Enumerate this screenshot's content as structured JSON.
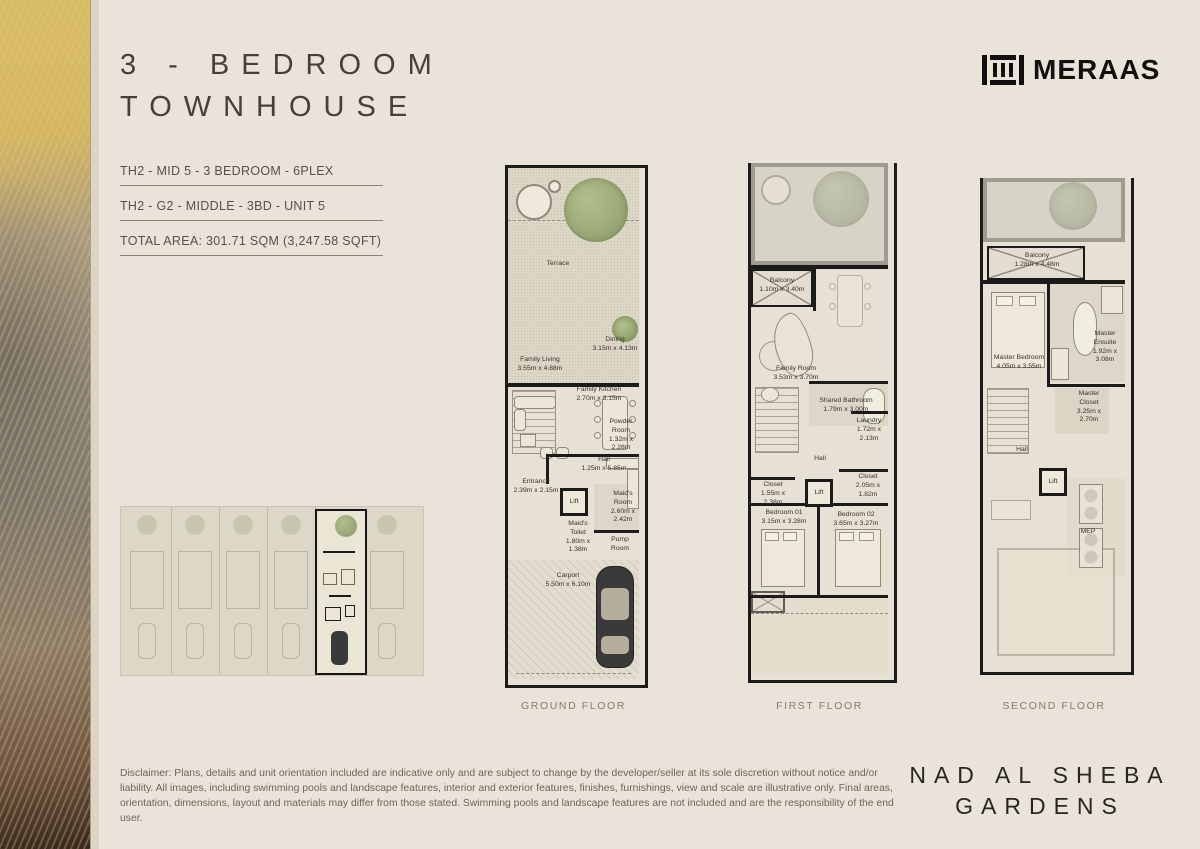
{
  "header": {
    "title": "3 - BEDROOM\nTOWNHOUSE",
    "unit_code": "TH2 - MID 5 - 3 BEDROOM - 6PLEX",
    "unit_detail": "TH2 - G2 - MIDDLE - 3BD - UNIT 5",
    "total_area": "TOTAL AREA: 301.71 SQM (3,247.58 SQFT)",
    "brand": "MERAAS"
  },
  "icons": {
    "logo_mark": "meraas-bars-glyph"
  },
  "plans": {
    "ground": {
      "name": "GROUND FLOOR",
      "rooms": {
        "terrace": "Terrace",
        "dining": "Dining\n3.15m x 4.13m",
        "family_living": "Family Living\n3.55m x 4.88m",
        "family_kitchen": "Family Kitchen\n2.70m x 3.15m",
        "powder_room": "Powder\nRoom\n1.32m x\n2.28m",
        "hall": "Hall\n1.25m x 5.85m",
        "entrance": "Entrance\n2.39m x 2.15m",
        "lift": "Lift",
        "maids_room": "Maid's\nRoom\n2.60m x\n2.42m",
        "maids_toilet": "Maid's\nToilet\n1.80m x\n1.38m",
        "pump_room": "Pump\nRoom",
        "carport": "Carport\n5.50m x 6.10m"
      }
    },
    "first": {
      "name": "FIRST FLOOR",
      "rooms": {
        "balcony": "Balcony\n1.10m x 3.40m",
        "family_room": "Family Room\n3.53m x 3.70m",
        "shared_bathroom": "Shared Bathroom\n1.79m x 3.00m",
        "laundry": "Laundry\n1.72m x\n2.13m",
        "hall": "Hall",
        "closet_1": "Closet\n1.55m x\n2.38m",
        "lift": "Lift",
        "closet_2": "Closet\n2.05m x\n1.82m",
        "bedroom_01": "Bedroom 01\n3.15m x 3.28m",
        "bedroom_02": "Bedroom 02\n3.65m x 3.27m"
      }
    },
    "second": {
      "name": "SECOND FLOOR",
      "rooms": {
        "balcony": "Balcony\n1.28m x 4.48m",
        "master_bedroom": "Master Bedroom\n4.05m x 3.55m",
        "master_ensuite": "Master\nEnsuite\n1.92m x\n3.08m",
        "master_closet": "Master\nCloset\n3.25m x\n2.70m",
        "hall": "Hall",
        "lift": "Lift",
        "mep": "MEP"
      }
    }
  },
  "footer": {
    "disclaimer": "Disclaimer: Plans, details and unit orientation included are indicative only and are subject to change by the developer/seller at its sole discretion without notice and/or liability. All images, including swimming pools and landscape features, interior and exterior features, finishes, furnishings, view and scale are illustrative only. Final areas, orientation, dimensions, layout and materials may differ from those stated. Swimming pools and landscape features are not included and are the responsibility of the end user.",
    "project": "NAD AL SHEBA\nGARDENS"
  },
  "colors": {
    "page_bg": "#e9e3d9",
    "plan_bg": "#e7e1d5",
    "wall": "#1b1b1b",
    "garden_green": "#9cab77",
    "text_dark": "#474039",
    "text_muted": "#6e6459"
  }
}
